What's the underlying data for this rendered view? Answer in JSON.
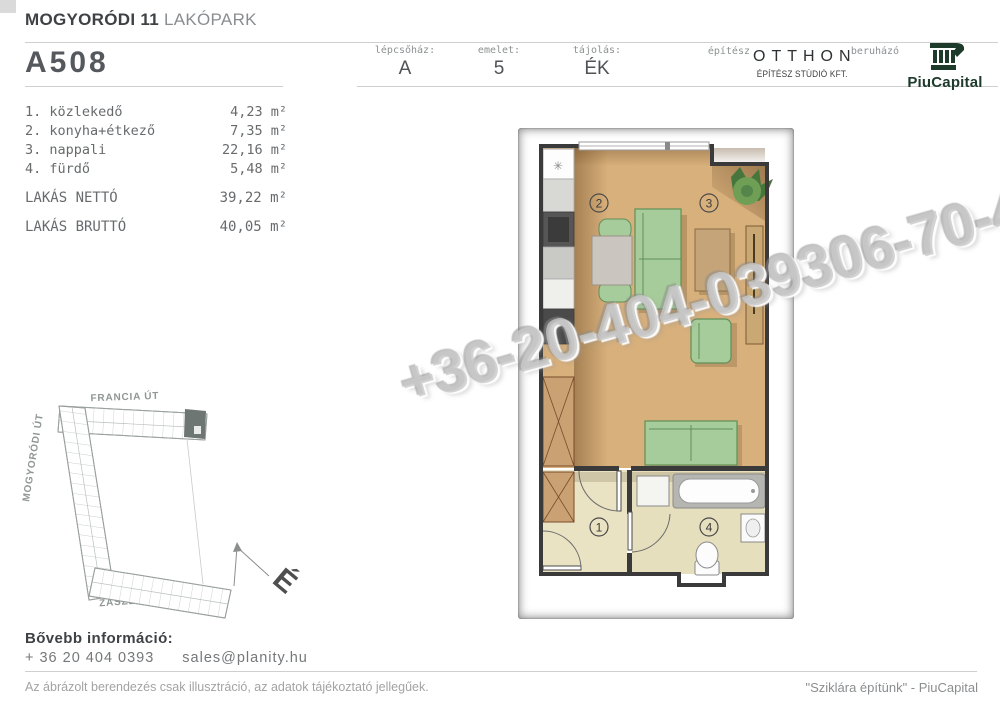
{
  "header": {
    "project_title_bold": "MOGYORÓDI 11",
    "project_title_light": "LAKÓPARK",
    "unit_code": "A508",
    "cells": [
      {
        "label": "lépcsőház:",
        "value": "A"
      },
      {
        "label": "emelet:",
        "value": "5"
      },
      {
        "label": "tájolás:",
        "value": "ÉK"
      }
    ],
    "architect_label": "építész",
    "architect_name": "OTTHON",
    "architect_sub": "ÉPÍTÉSZ STÚDIÓ KFT.",
    "developer_label": "beruházó",
    "developer_name": "PiuCapital"
  },
  "rooms": {
    "items": [
      {
        "num": "1.",
        "name": "közlekedő",
        "area": "4,23 m²"
      },
      {
        "num": "2.",
        "name": "konyha+étkező",
        "area": "7,35 m²"
      },
      {
        "num": "3.",
        "name": "nappali",
        "area": "22,16 m²"
      },
      {
        "num": "4.",
        "name": "fürdő",
        "area": "5,48 m²"
      }
    ],
    "net_label": "LAKÁS NETTÓ",
    "net_area": "39,22 m²",
    "gross_label": "LAKÁS BRUTTÓ",
    "gross_area": "40,05 m²"
  },
  "floor_plan": {
    "room_numbers": [
      "1",
      "2",
      "3",
      "4"
    ],
    "watermark": "+36-20-404-039306-70-442-2"
  },
  "site_plan": {
    "street_top": "FRANCIA ÚT",
    "street_left": "MOGYORÓDI ÚT",
    "street_bottom": "ZÁSZLÓS U.",
    "compass": "É"
  },
  "contact": {
    "heading": "Bővebb információ:",
    "phone": "+ 36 20 404 0393",
    "email": "sales@planity.hu"
  },
  "footer": {
    "disclaimer": "Az ábrázolt berendezés csak illusztráció, az adatok tájékoztató jellegűek.",
    "slogan": "\"Sziklára építünk\" - PiuCapital"
  },
  "colors": {
    "brand_green": "#1e3a2b",
    "wood_floor": "#d8b07c",
    "tile_floor": "#e9e2c3",
    "furniture_green": "#a7cc9b",
    "highlight_unit": "#6e7673"
  }
}
